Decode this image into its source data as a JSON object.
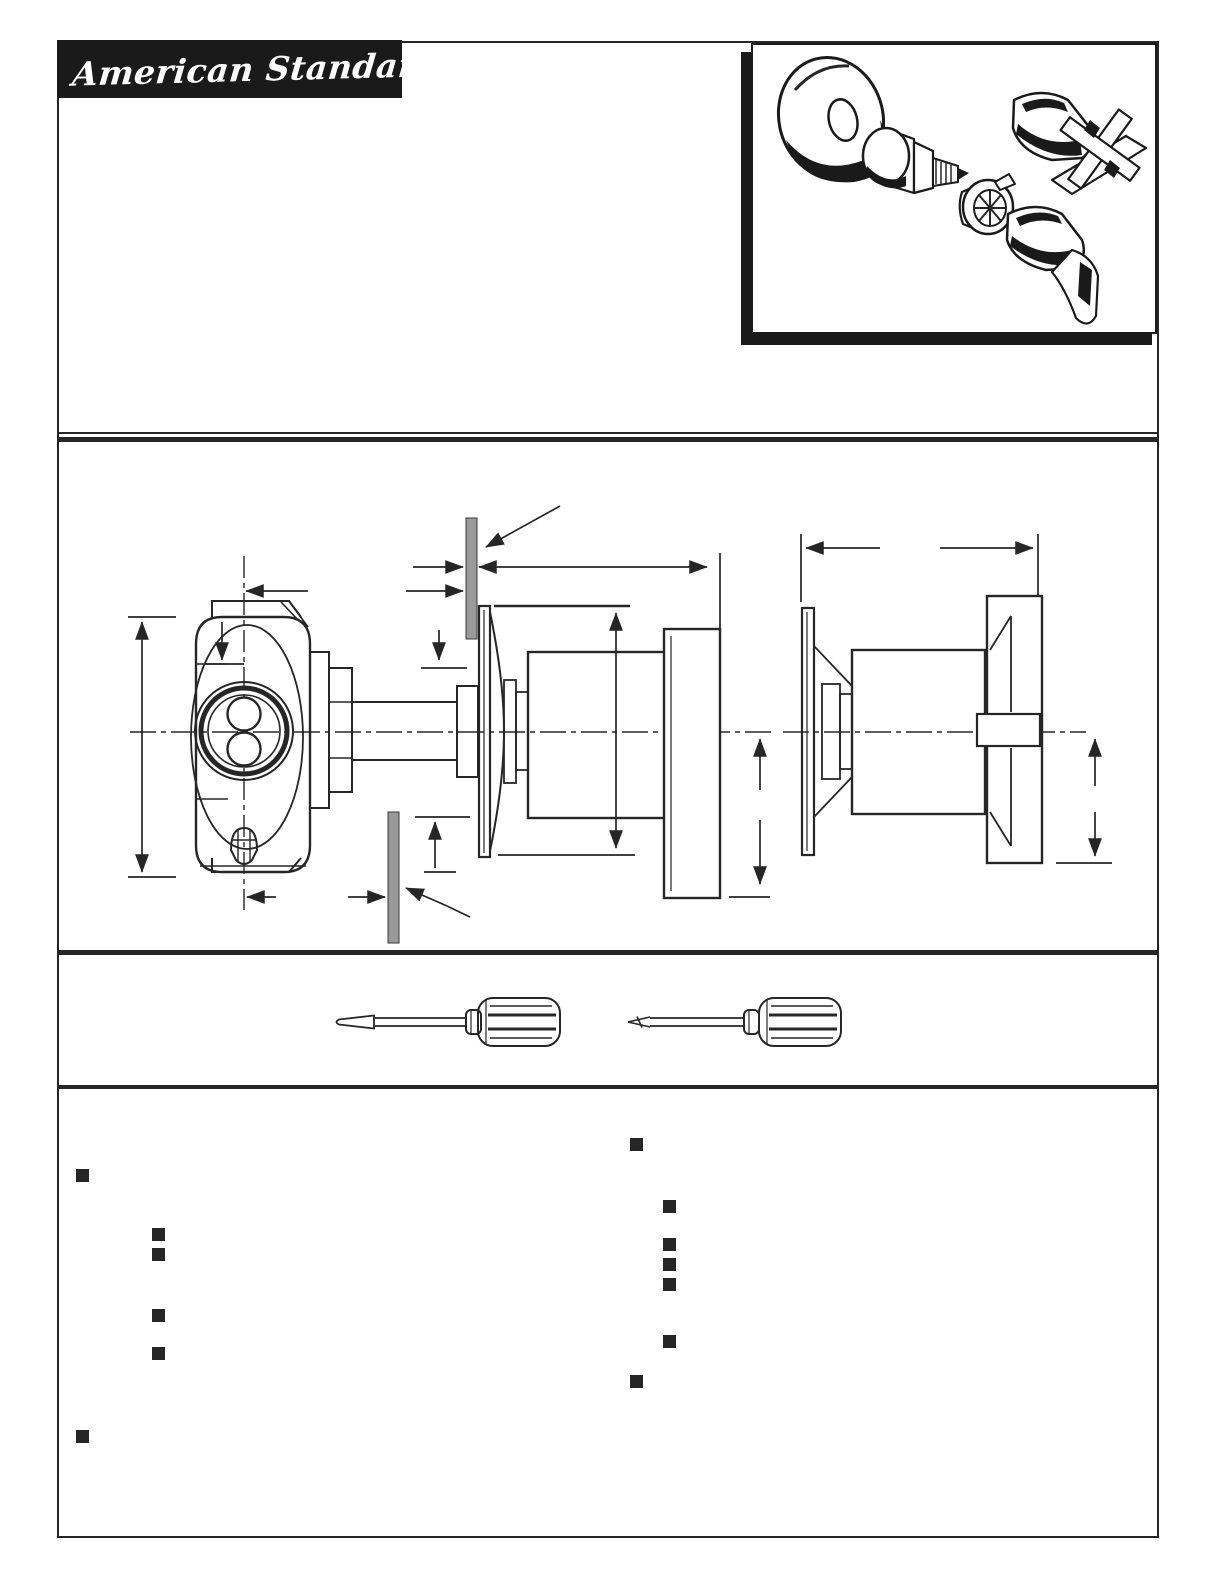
{
  "header": {
    "logo_text": "American Standard"
  },
  "colors": {
    "ink": "#262626",
    "illustration_black": "#1a1a1a",
    "finished_wall_gray": "#9a9a9a",
    "paper": "#ffffff"
  },
  "exploded_view": {
    "parts": [
      {
        "name": "escutcheon"
      },
      {
        "name": "valve-cartridge"
      },
      {
        "name": "handle-adapter"
      },
      {
        "name": "cross-handle"
      },
      {
        "name": "lever-handle"
      }
    ]
  },
  "drawing": {
    "views": [
      {
        "name": "lever-handle-installation-section"
      },
      {
        "name": "cross-handle-installation-section"
      }
    ],
    "finished_wall_markers": 2
  },
  "tools": {
    "items": [
      {
        "name": "flathead-screwdriver"
      },
      {
        "name": "phillips-screwdriver"
      }
    ]
  },
  "notes": {
    "bullet_size": 13,
    "left_column": {
      "bullets": [
        {
          "indent": 0,
          "x": 76,
          "y": 1169
        },
        {
          "indent": 1,
          "x": 152,
          "y": 1228
        },
        {
          "indent": 1,
          "x": 152,
          "y": 1248
        },
        {
          "indent": 1,
          "x": 152,
          "y": 1309
        },
        {
          "indent": 1,
          "x": 152,
          "y": 1347
        },
        {
          "indent": 0,
          "x": 76,
          "y": 1430
        }
      ]
    },
    "right_column": {
      "bullets": [
        {
          "indent": 0,
          "x": 630,
          "y": 1138
        },
        {
          "indent": 1,
          "x": 663,
          "y": 1200
        },
        {
          "indent": 1,
          "x": 663,
          "y": 1238
        },
        {
          "indent": 1,
          "x": 663,
          "y": 1258
        },
        {
          "indent": 1,
          "x": 663,
          "y": 1278
        },
        {
          "indent": 1,
          "x": 663,
          "y": 1335
        },
        {
          "indent": 0,
          "x": 630,
          "y": 1375
        }
      ]
    }
  }
}
